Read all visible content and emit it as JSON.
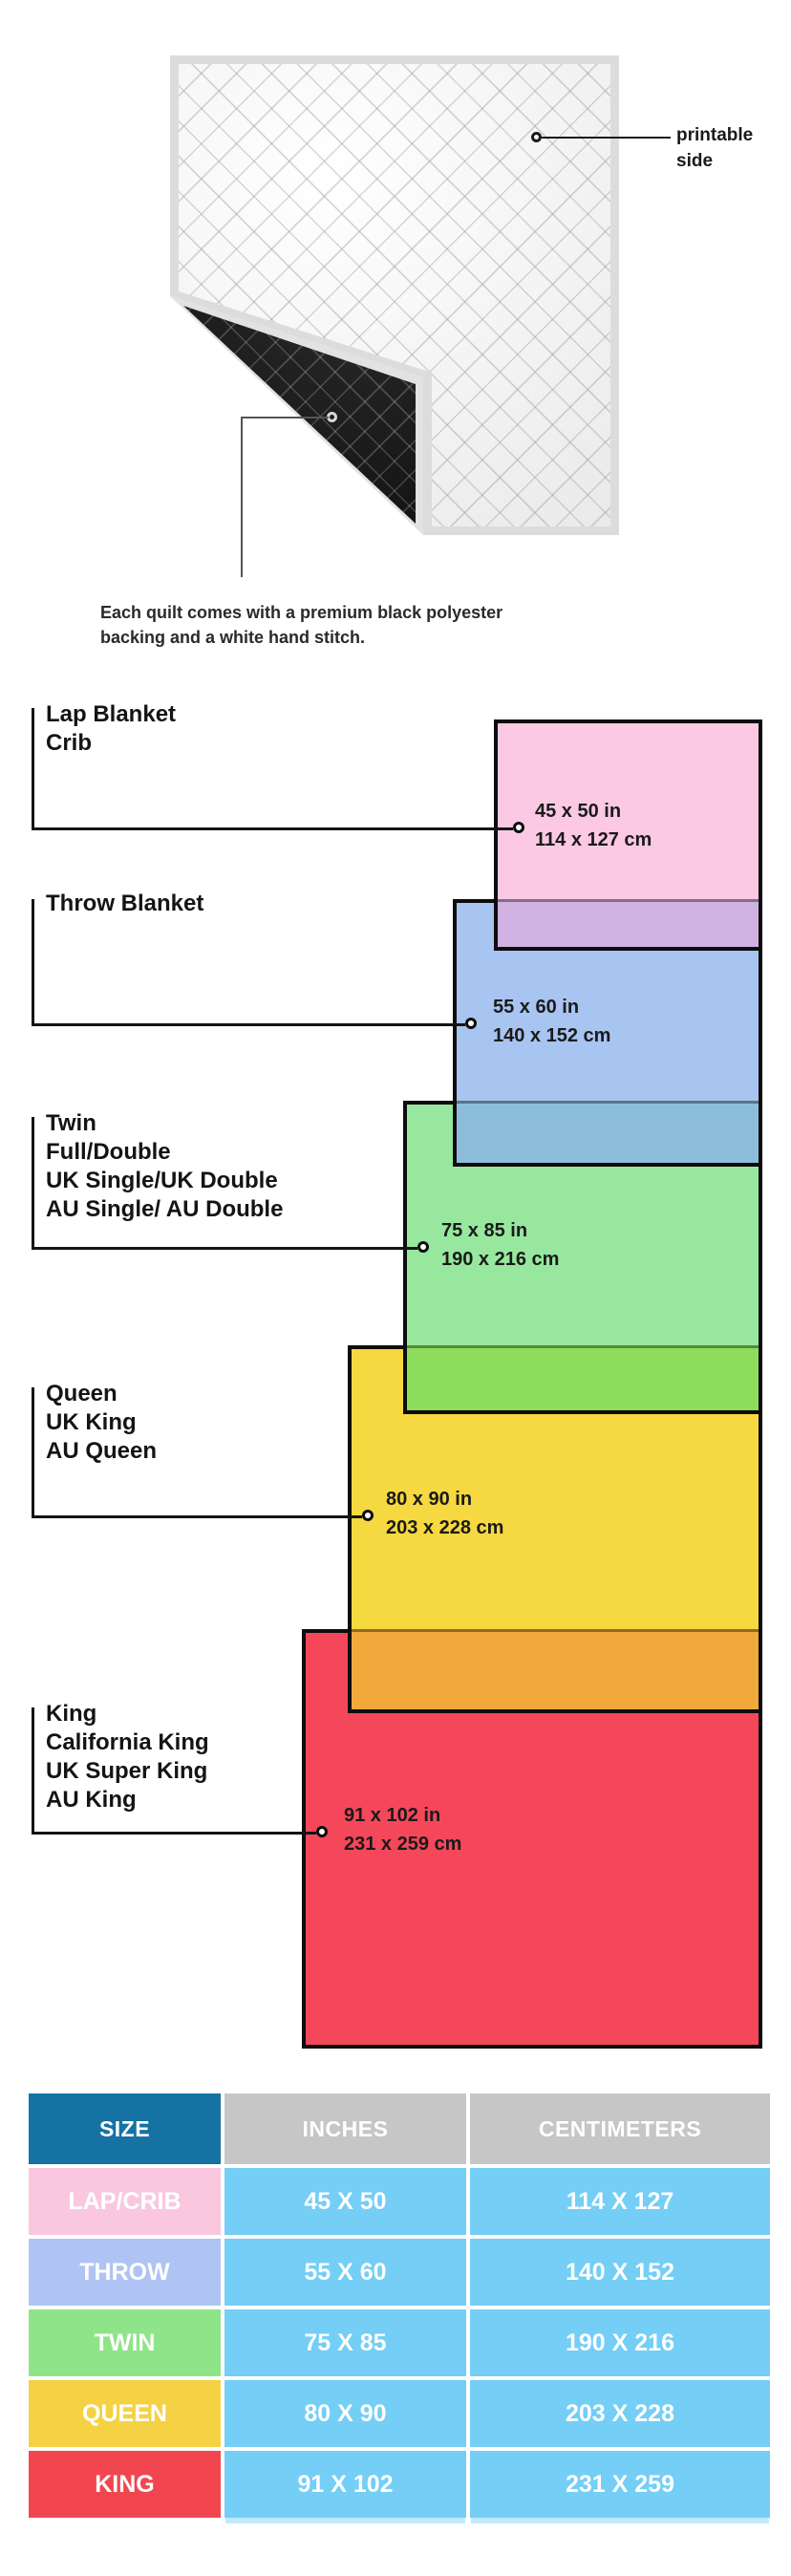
{
  "figure": {
    "printable_label": "printable side",
    "caption": "Each quilt comes with a premium black polyester backing and a white hand stitch."
  },
  "diagram": {
    "sizes": [
      {
        "id": "lap",
        "names": [
          "Lap Blanket",
          "Crib"
        ],
        "inches": "45 x 50 in",
        "cm": "114 x 127 cm",
        "color": "#FBC9E3"
      },
      {
        "id": "throw",
        "names": [
          "Throw Blanket"
        ],
        "inches": "55 x 60 in",
        "cm": "140 x 152 cm",
        "color": "#A8C4F1"
      },
      {
        "id": "twin",
        "names": [
          "Twin",
          "Full/Double",
          "UK Single/UK Double",
          "AU Single/ AU Double"
        ],
        "inches": "75 x 85 in",
        "cm": "190 x 216 cm",
        "color": "#97E89E"
      },
      {
        "id": "queen",
        "names": [
          "Queen",
          "UK King",
          "AU Queen"
        ],
        "inches": "80 x 90 in",
        "cm": "203 x 228 cm",
        "color": "#F6D840"
      },
      {
        "id": "king",
        "names": [
          "King",
          "California King",
          "UK Super King",
          "AU King"
        ],
        "inches": "91 x 102 in",
        "cm": "231 x 259 cm",
        "color": "#F4485A"
      }
    ],
    "overlap_colors": [
      "#D0B3E3",
      "#8CBEDC",
      "#8EDC5B",
      "#F1A93C"
    ]
  },
  "table": {
    "headers": [
      "SIZE",
      "INCHES",
      "CENTIMETERS"
    ],
    "header_size_bg": "#1572A2",
    "header_other_bg": "#C6C6C6",
    "cell_bg": "#74CEF6",
    "rows": [
      {
        "size": "LAP/CRIB",
        "inches": "45 X 50",
        "cm": "114 X 127",
        "color": "#F9C8DF"
      },
      {
        "size": "THROW",
        "inches": "55 X 60",
        "cm": "140 X 152",
        "color": "#AFC4F4"
      },
      {
        "size": "TWIN",
        "inches": "75 X 85",
        "cm": "190 X 216",
        "color": "#8FE489"
      },
      {
        "size": "QUEEN",
        "inches": "80 X 90",
        "cm": "203 X 228",
        "color": "#F4D243"
      },
      {
        "size": "KING",
        "inches": "91 X 102",
        "cm": "231 X 259",
        "color": "#F1464F"
      }
    ]
  }
}
